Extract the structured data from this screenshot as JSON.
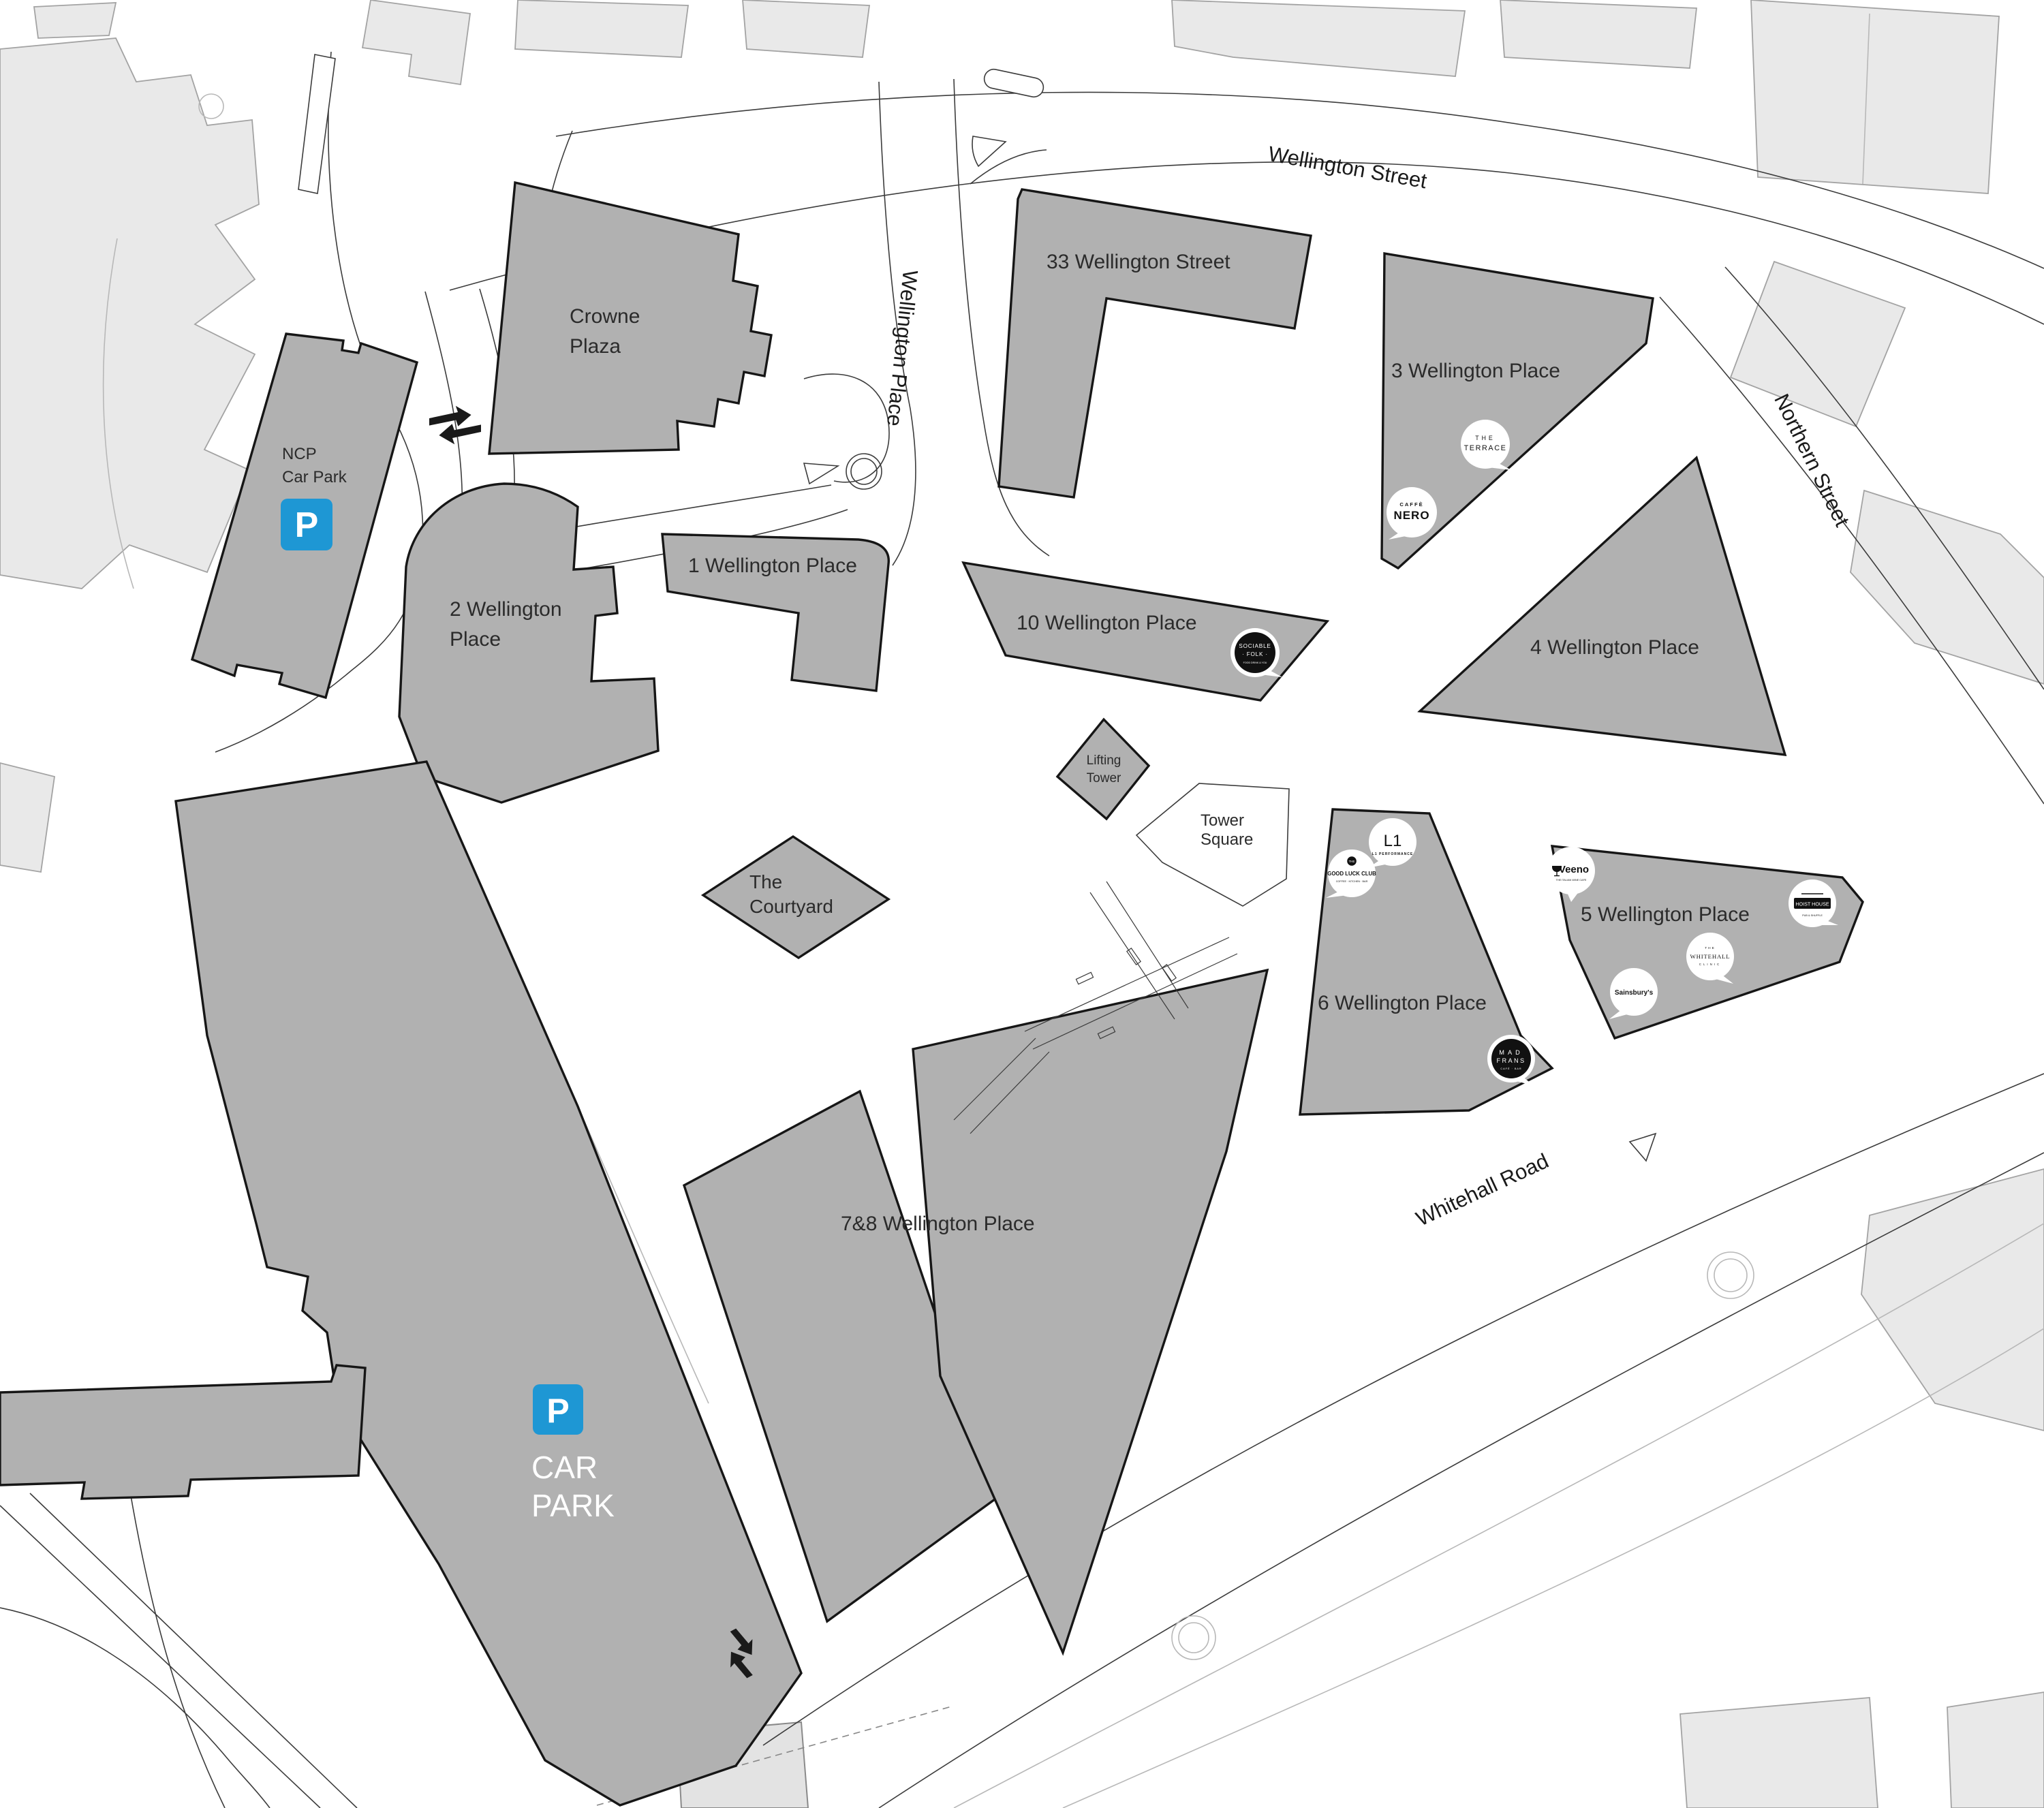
{
  "title": "Wellington Place site map",
  "colors": {
    "building_fill": "#b1b1b1",
    "building_stroke": "#161616",
    "context_fill": "#e9e9e9",
    "road_stroke": "#3c3c3c",
    "parking_blue": "#1e97d4",
    "label_text": "#2b2b2b",
    "background": "#ffffff"
  },
  "streets": {
    "wellington_street": "Wellington Street",
    "wellington_place": "Wellington Place",
    "northern_street": "Northern Street",
    "whitehall_road": "Whitehall Road"
  },
  "buildings": {
    "crowne_plaza": {
      "line1": "Crowne",
      "line2": "Plaza"
    },
    "ncp": {
      "line1": "NCP",
      "line2": "Car Park",
      "p": "P"
    },
    "wp1": {
      "label": "1 Wellington Place"
    },
    "wp2": {
      "line1": "2 Wellington",
      "line2": "Place"
    },
    "wp3": {
      "label": "3 Wellington Place"
    },
    "wp4": {
      "label": "4 Wellington Place"
    },
    "wp5": {
      "label": "5 Wellington Place"
    },
    "wp6": {
      "label": "6 Wellington Place"
    },
    "wp78": {
      "label": "7&8 Wellington Place"
    },
    "wp10": {
      "label": "10 Wellington Place"
    },
    "ws33": {
      "label": "33 Wellington Street"
    },
    "courtyard": {
      "line1": "The",
      "line2": "Courtyard"
    },
    "lifting_tower": {
      "line1": "Lifting",
      "line2": "Tower"
    },
    "tower_square": {
      "line1": "Tower",
      "line2": "Square"
    },
    "car_park": {
      "p": "P",
      "line1": "CAR",
      "line2": "PARK"
    }
  },
  "tenants": {
    "terrace": {
      "line1": "THE",
      "line2": "TERRACE"
    },
    "caffe_nero": {
      "line1": "CAFFÈ",
      "line2": "NERO"
    },
    "sociable_folk": {
      "line1": "SOCIABLE",
      "line2": "· FOLK ·",
      "line3": "FOOD DRINK & YOU"
    },
    "l1_performance": {
      "line1": "L1",
      "line2": "L1 PERFORMANCE"
    },
    "good_luck_club": {
      "line0": "THE",
      "line1": "GOOD LUCK CLUB",
      "line2": "COFFEE · KITCHEN · BAR"
    },
    "mad_frans": {
      "line1": "MAD",
      "line2": "FRANS",
      "line3": "CAFÉ · BAR"
    },
    "veeno": {
      "line1": "Veeno",
      "line2": "THE ITALIAN WINE CAFE"
    },
    "whitehall_clinic": {
      "line1": "THE",
      "line2": "WHITEHALL",
      "line3": "CLINIC"
    },
    "sainsburys": {
      "line1": "Sainsbury's"
    },
    "hoist_house": {
      "line1": "HOIST HOUSE",
      "line2": "PUB & SHUFFLE"
    }
  }
}
